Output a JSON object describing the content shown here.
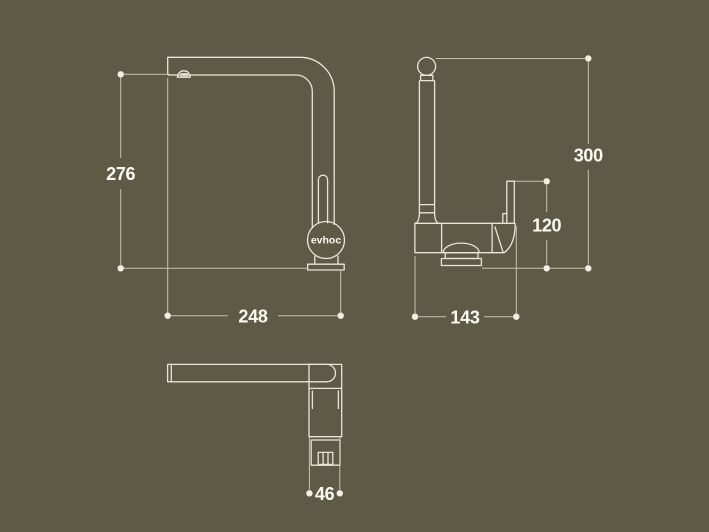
{
  "title": "Faucet dimensional drawing",
  "colors": {
    "background": "#5f5a46",
    "outline": "#eae6d3",
    "dimension": "#c7c2ad",
    "dot": "#f2efe2",
    "label": "#fbfaf3"
  },
  "brand": {
    "logo_text": "evhoc"
  },
  "views": {
    "front": {
      "height_mm": "276",
      "width_mm": "248"
    },
    "side": {
      "height_mm": "300",
      "handle_height_mm": "120",
      "width_mm": "143"
    },
    "top": {
      "width_mm": "46"
    }
  }
}
